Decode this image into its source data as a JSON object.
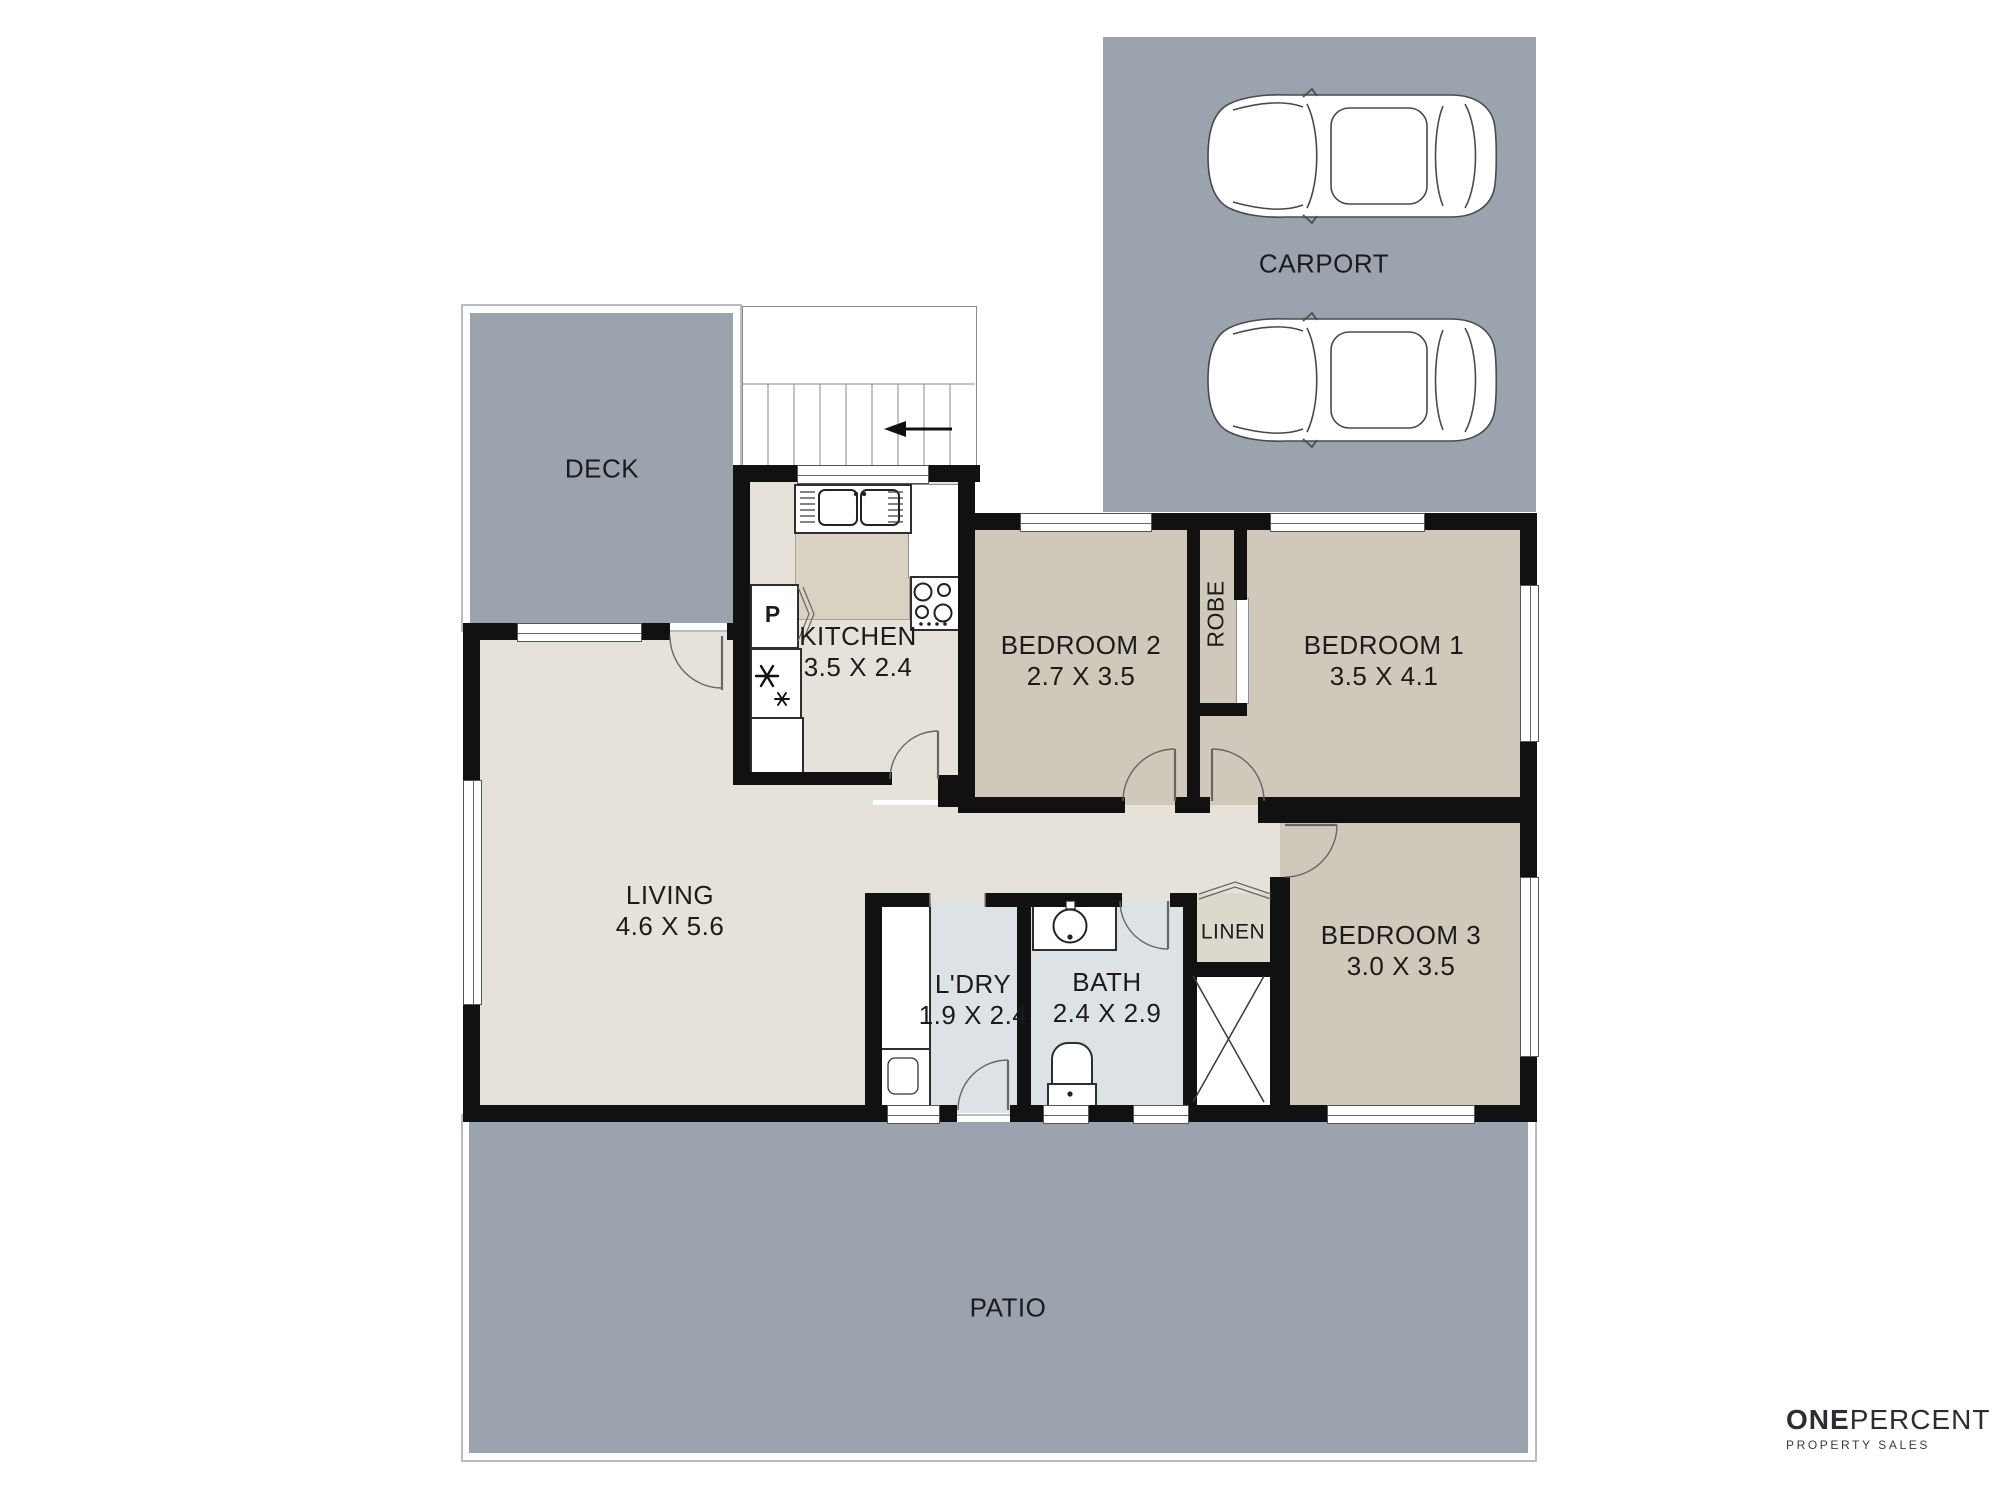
{
  "plan": {
    "outdoor": {
      "deck": "DECK",
      "carport": "CARPORT",
      "patio": "PATIO"
    },
    "rooms": {
      "living": {
        "name": "LIVING",
        "dims": "4.6 X 5.6"
      },
      "kitchen": {
        "name": "KITCHEN",
        "dims": "3.5 X 2.4"
      },
      "bedroom1": {
        "name": "BEDROOM 1",
        "dims": "3.5 X 4.1"
      },
      "bedroom2": {
        "name": "BEDROOM 2",
        "dims": "2.7 X 3.5"
      },
      "bedroom3": {
        "name": "BEDROOM 3",
        "dims": "3.0 X 3.5"
      },
      "laundry": {
        "name": "L'DRY",
        "dims": "1.9 X 2.4"
      },
      "bath": {
        "name": "BATH",
        "dims": "2.4 X 2.9"
      }
    },
    "closets": {
      "robe": "ROBE",
      "linen": "LINEN",
      "pantry": "P"
    }
  },
  "branding": {
    "name_bold": "ONE",
    "name_light": "PERCENT",
    "tagline": "PROPERTY SALES"
  },
  "colors": {
    "outdoor_gray": "#9ba3ae",
    "floor_light": "#e6e2d9",
    "floor_bedroom": "#cfc8bb",
    "floor_wet": "#dde2e6",
    "floor_linen": "#ddd8cc",
    "counter_tan": "#d9d2c3",
    "wall": "#111111",
    "logo": "#2c2c34"
  }
}
